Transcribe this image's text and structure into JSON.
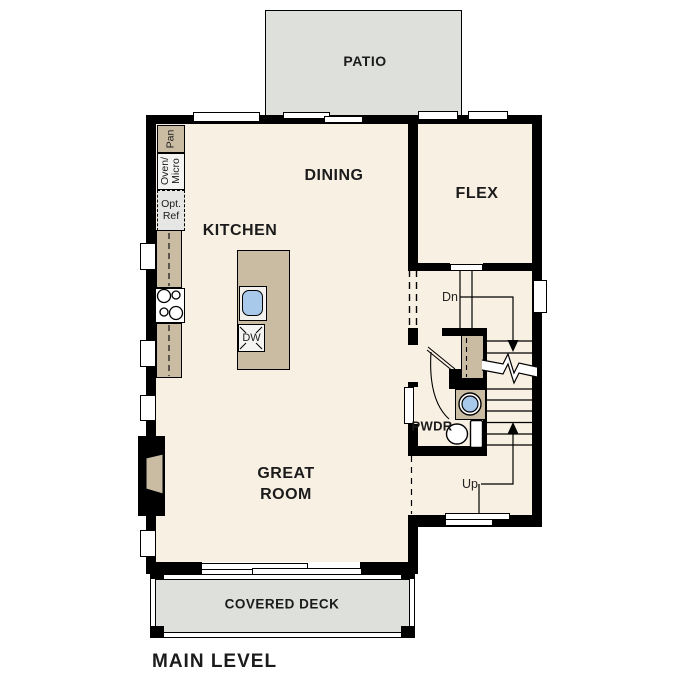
{
  "title": "MAIN LEVEL",
  "rooms": {
    "patio": "PATIO",
    "dining": "DINING",
    "kitchen": "KITCHEN",
    "flex": "FLEX",
    "great_room_line1": "GREAT",
    "great_room_line2": "ROOM",
    "powder": "PWDR",
    "covered_deck": "COVERED DECK"
  },
  "fixtures": {
    "pantry": "Pan",
    "oven_micro_line1": "Oven/",
    "oven_micro_line2": "Micro",
    "opt_ref_line1": "Opt.",
    "opt_ref_line2": "Ref",
    "dishwasher": "DW"
  },
  "stairs": {
    "down": "Dn",
    "up": "Up"
  },
  "colors": {
    "floor": "#F8F0E3",
    "casework_tan": "#C9BCA3",
    "patio_gray": "#DEE0DC",
    "sink_blue": "#A9C9EB",
    "wall_black": "#000000"
  }
}
